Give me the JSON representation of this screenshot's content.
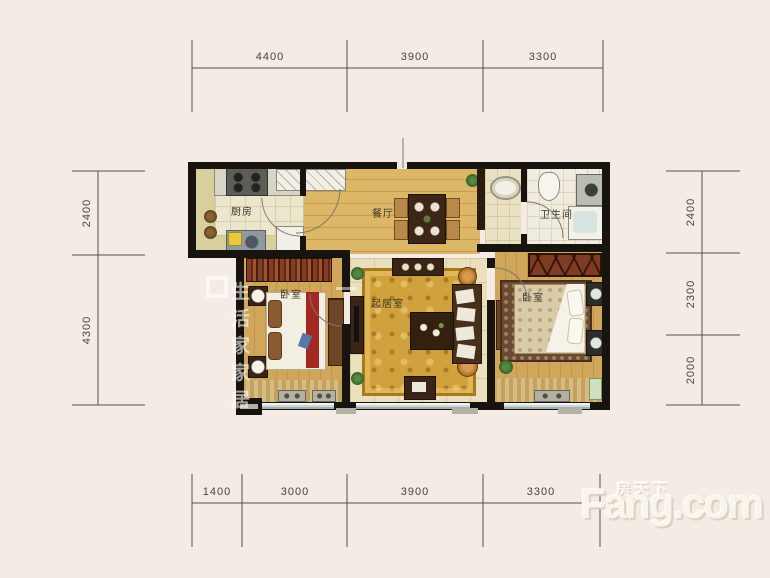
{
  "background_color": "#f4ece4",
  "rooms": {
    "kitchen": "厨房",
    "dining": "餐厅",
    "bathroom": "卫生间",
    "bedroom_left": "卧室",
    "living_room": "起居室",
    "bedroom_right": "卧室"
  },
  "dimensions_mm": {
    "top": [
      "4400",
      "3900",
      "3300"
    ],
    "bottom": [
      "1400",
      "3000",
      "3900",
      "3300"
    ],
    "left": [
      "2400",
      "4300"
    ],
    "right": [
      "2400",
      "2300",
      "2000"
    ]
  },
  "watermark": {
    "text": "生活家家居"
  },
  "brand": {
    "name_cn": "房天下",
    "name_en": "Fang.com"
  },
  "colors": {
    "wall": "#17130e",
    "wood_floor": "#d9b766",
    "bedroom_floor": "#cfa557",
    "rug_gold": "#d0a23d",
    "window": "#cdd8d6",
    "accent_red": "#a32822"
  }
}
